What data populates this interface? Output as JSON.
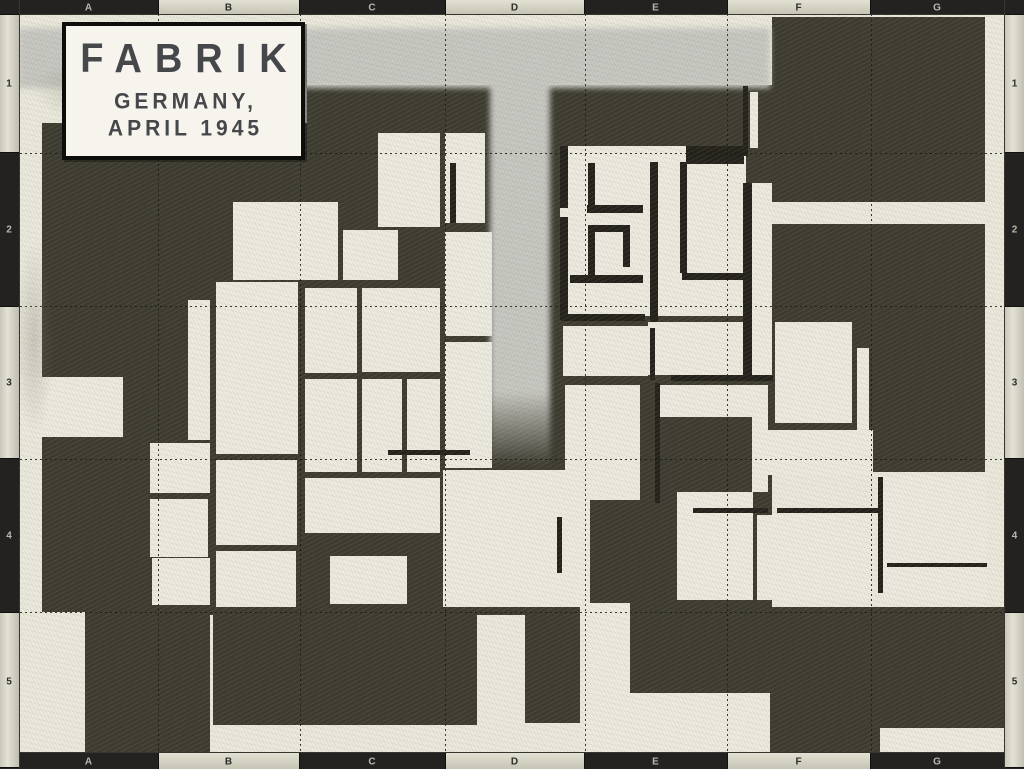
{
  "title": {
    "line1": "FABRIK",
    "line2": "GERMANY,",
    "line3": "APRIL 1945"
  },
  "frame": {
    "top_labels": [
      "A",
      "B",
      "C",
      "D",
      "E",
      "F",
      "G"
    ],
    "bottom_labels": [
      "A",
      "B",
      "C",
      "D",
      "E",
      "F",
      "G"
    ],
    "left_labels": [
      "1",
      "2",
      "3",
      "4",
      "5"
    ],
    "right_labels": [
      "1",
      "2",
      "3",
      "4",
      "5"
    ],
    "light_columns": [
      false,
      true,
      false,
      true,
      false,
      true,
      false
    ],
    "light_rows": [
      true,
      false,
      true,
      false,
      true
    ],
    "col_bounds": [
      20,
      158,
      300,
      445,
      585,
      727,
      871,
      1004
    ],
    "row_bounds": [
      14,
      153,
      306,
      459,
      612,
      752
    ],
    "bar_color": "#232220",
    "tab_color": "#d8d6c6"
  },
  "map": {
    "colors": {
      "paper": "#ebe9dc",
      "building": "#3e3c30",
      "room": "#edebdf",
      "wall": "#24221b",
      "road": "#c7c7c1"
    },
    "grid_v": [
      158,
      300,
      445,
      585,
      727,
      871
    ],
    "grid_h": [
      153,
      306,
      459,
      612
    ],
    "roads": [
      {
        "name": "road-top",
        "x": 18,
        "y": 28,
        "w": 752,
        "h": 60,
        "vert": false
      },
      {
        "name": "road-stem",
        "x": 490,
        "y": 54,
        "w": 60,
        "h": 412,
        "vert": true
      }
    ],
    "dark_blocks": [
      [
        42,
        123,
        265,
        250
      ],
      [
        42,
        373,
        101,
        239
      ],
      [
        143,
        373,
        164,
        239
      ],
      [
        307,
        85,
        465,
        527
      ],
      [
        772,
        17,
        213,
        185
      ],
      [
        772,
        224,
        213,
        248
      ],
      [
        85,
        612,
        125,
        140
      ],
      [
        213,
        612,
        264,
        113
      ],
      [
        525,
        612,
        55,
        111
      ],
      [
        630,
        607,
        374,
        145
      ],
      [
        192,
        605,
        333,
        10
      ]
    ],
    "rooms": [
      [
        20,
        377,
        103,
        60
      ],
      [
        233,
        202,
        105,
        78
      ],
      [
        343,
        230,
        55,
        50
      ],
      [
        188,
        300,
        22,
        140
      ],
      [
        216,
        282,
        82,
        172
      ],
      [
        150,
        443,
        60,
        50
      ],
      [
        150,
        499,
        58,
        58
      ],
      [
        152,
        558,
        58,
        47
      ],
      [
        216,
        460,
        81,
        85
      ],
      [
        216,
        551,
        80,
        56
      ],
      [
        305,
        288,
        52,
        85
      ],
      [
        362,
        288,
        78,
        84
      ],
      [
        305,
        379,
        52,
        93
      ],
      [
        362,
        379,
        40,
        93
      ],
      [
        407,
        379,
        33,
        93
      ],
      [
        305,
        478,
        135,
        55
      ],
      [
        330,
        556,
        77,
        48
      ],
      [
        378,
        133,
        62,
        94
      ],
      [
        445,
        133,
        40,
        90
      ],
      [
        445,
        232,
        47,
        104
      ],
      [
        445,
        342,
        47,
        126
      ],
      [
        443,
        470,
        147,
        137
      ],
      [
        560,
        146,
        186,
        170
      ],
      [
        752,
        183,
        20,
        197
      ],
      [
        750,
        92,
        8,
        56
      ],
      [
        563,
        326,
        85,
        50
      ],
      [
        565,
        385,
        75,
        115
      ],
      [
        648,
        322,
        98,
        53
      ],
      [
        655,
        385,
        113,
        32
      ],
      [
        752,
        417,
        16,
        75
      ],
      [
        677,
        492,
        76,
        108
      ],
      [
        760,
        430,
        113,
        45
      ],
      [
        883,
        477,
        104,
        123
      ],
      [
        757,
        515,
        118,
        85
      ],
      [
        775,
        322,
        77,
        101
      ],
      [
        857,
        348,
        12,
        124
      ],
      [
        580,
        603,
        50,
        149
      ],
      [
        580,
        693,
        190,
        59
      ],
      [
        880,
        728,
        124,
        24
      ]
    ],
    "walls": [
      [
        560,
        146,
        8,
        62
      ],
      [
        560,
        217,
        8,
        103
      ],
      [
        588,
        163,
        7,
        44
      ],
      [
        587,
        205,
        56,
        8
      ],
      [
        588,
        225,
        42,
        7
      ],
      [
        588,
        225,
        7,
        52
      ],
      [
        623,
        227,
        7,
        40
      ],
      [
        570,
        275,
        73,
        8
      ],
      [
        650,
        162,
        8,
        160
      ],
      [
        680,
        162,
        7,
        111
      ],
      [
        682,
        273,
        68,
        7
      ],
      [
        686,
        146,
        58,
        18
      ],
      [
        743,
        183,
        9,
        197
      ],
      [
        743,
        86,
        5,
        70
      ],
      [
        561,
        314,
        84,
        7
      ],
      [
        650,
        328,
        5,
        52
      ],
      [
        671,
        375,
        102,
        6
      ],
      [
        655,
        383,
        5,
        120
      ],
      [
        693,
        508,
        75,
        5
      ],
      [
        777,
        508,
        106,
        5
      ],
      [
        878,
        477,
        5,
        116
      ],
      [
        887,
        563,
        100,
        4
      ],
      [
        388,
        450,
        82,
        5
      ],
      [
        557,
        517,
        5,
        56
      ],
      [
        450,
        163,
        6,
        60
      ]
    ],
    "smudges": [
      {
        "x": 14,
        "y": 240,
        "w": 40,
        "h": 200
      },
      {
        "x": 30,
        "y": 60,
        "w": 120,
        "h": 60
      }
    ]
  }
}
